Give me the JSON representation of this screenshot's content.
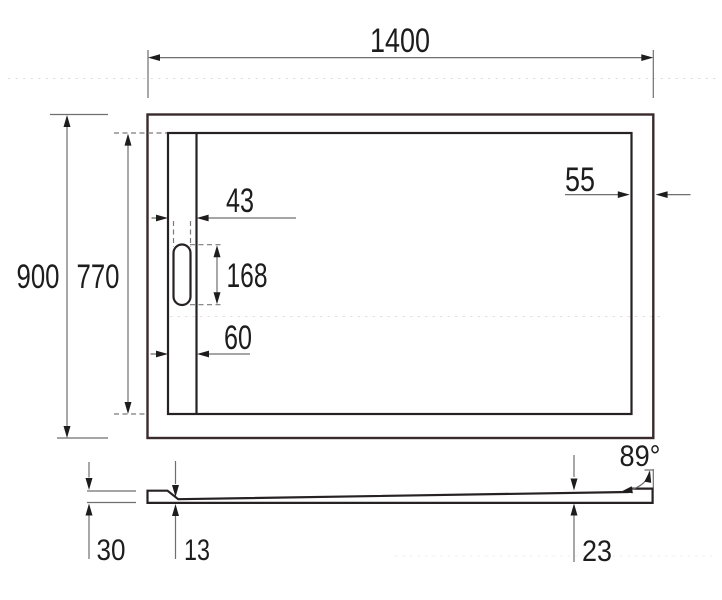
{
  "drawing": {
    "colors": {
      "background": "#ffffff",
      "outline": "#262223",
      "outer_outline_tint": "#392b2c",
      "dimension_line": "#6f6f6f",
      "dashed_line": "#7a7a7a",
      "label_text": "#1d1d1d"
    },
    "plan_view": {
      "overall_width": "1400",
      "overall_depth": "900",
      "inner_depth": "770",
      "drain_slot_width": "43",
      "drain_slot_length": "168",
      "drain_channel_width": "60",
      "rim_offset_right": "55"
    },
    "section_view": {
      "edge_height": "30",
      "thickness_at_drain": "13",
      "thickness_at_rim": "23",
      "rim_angle": "89°"
    }
  }
}
